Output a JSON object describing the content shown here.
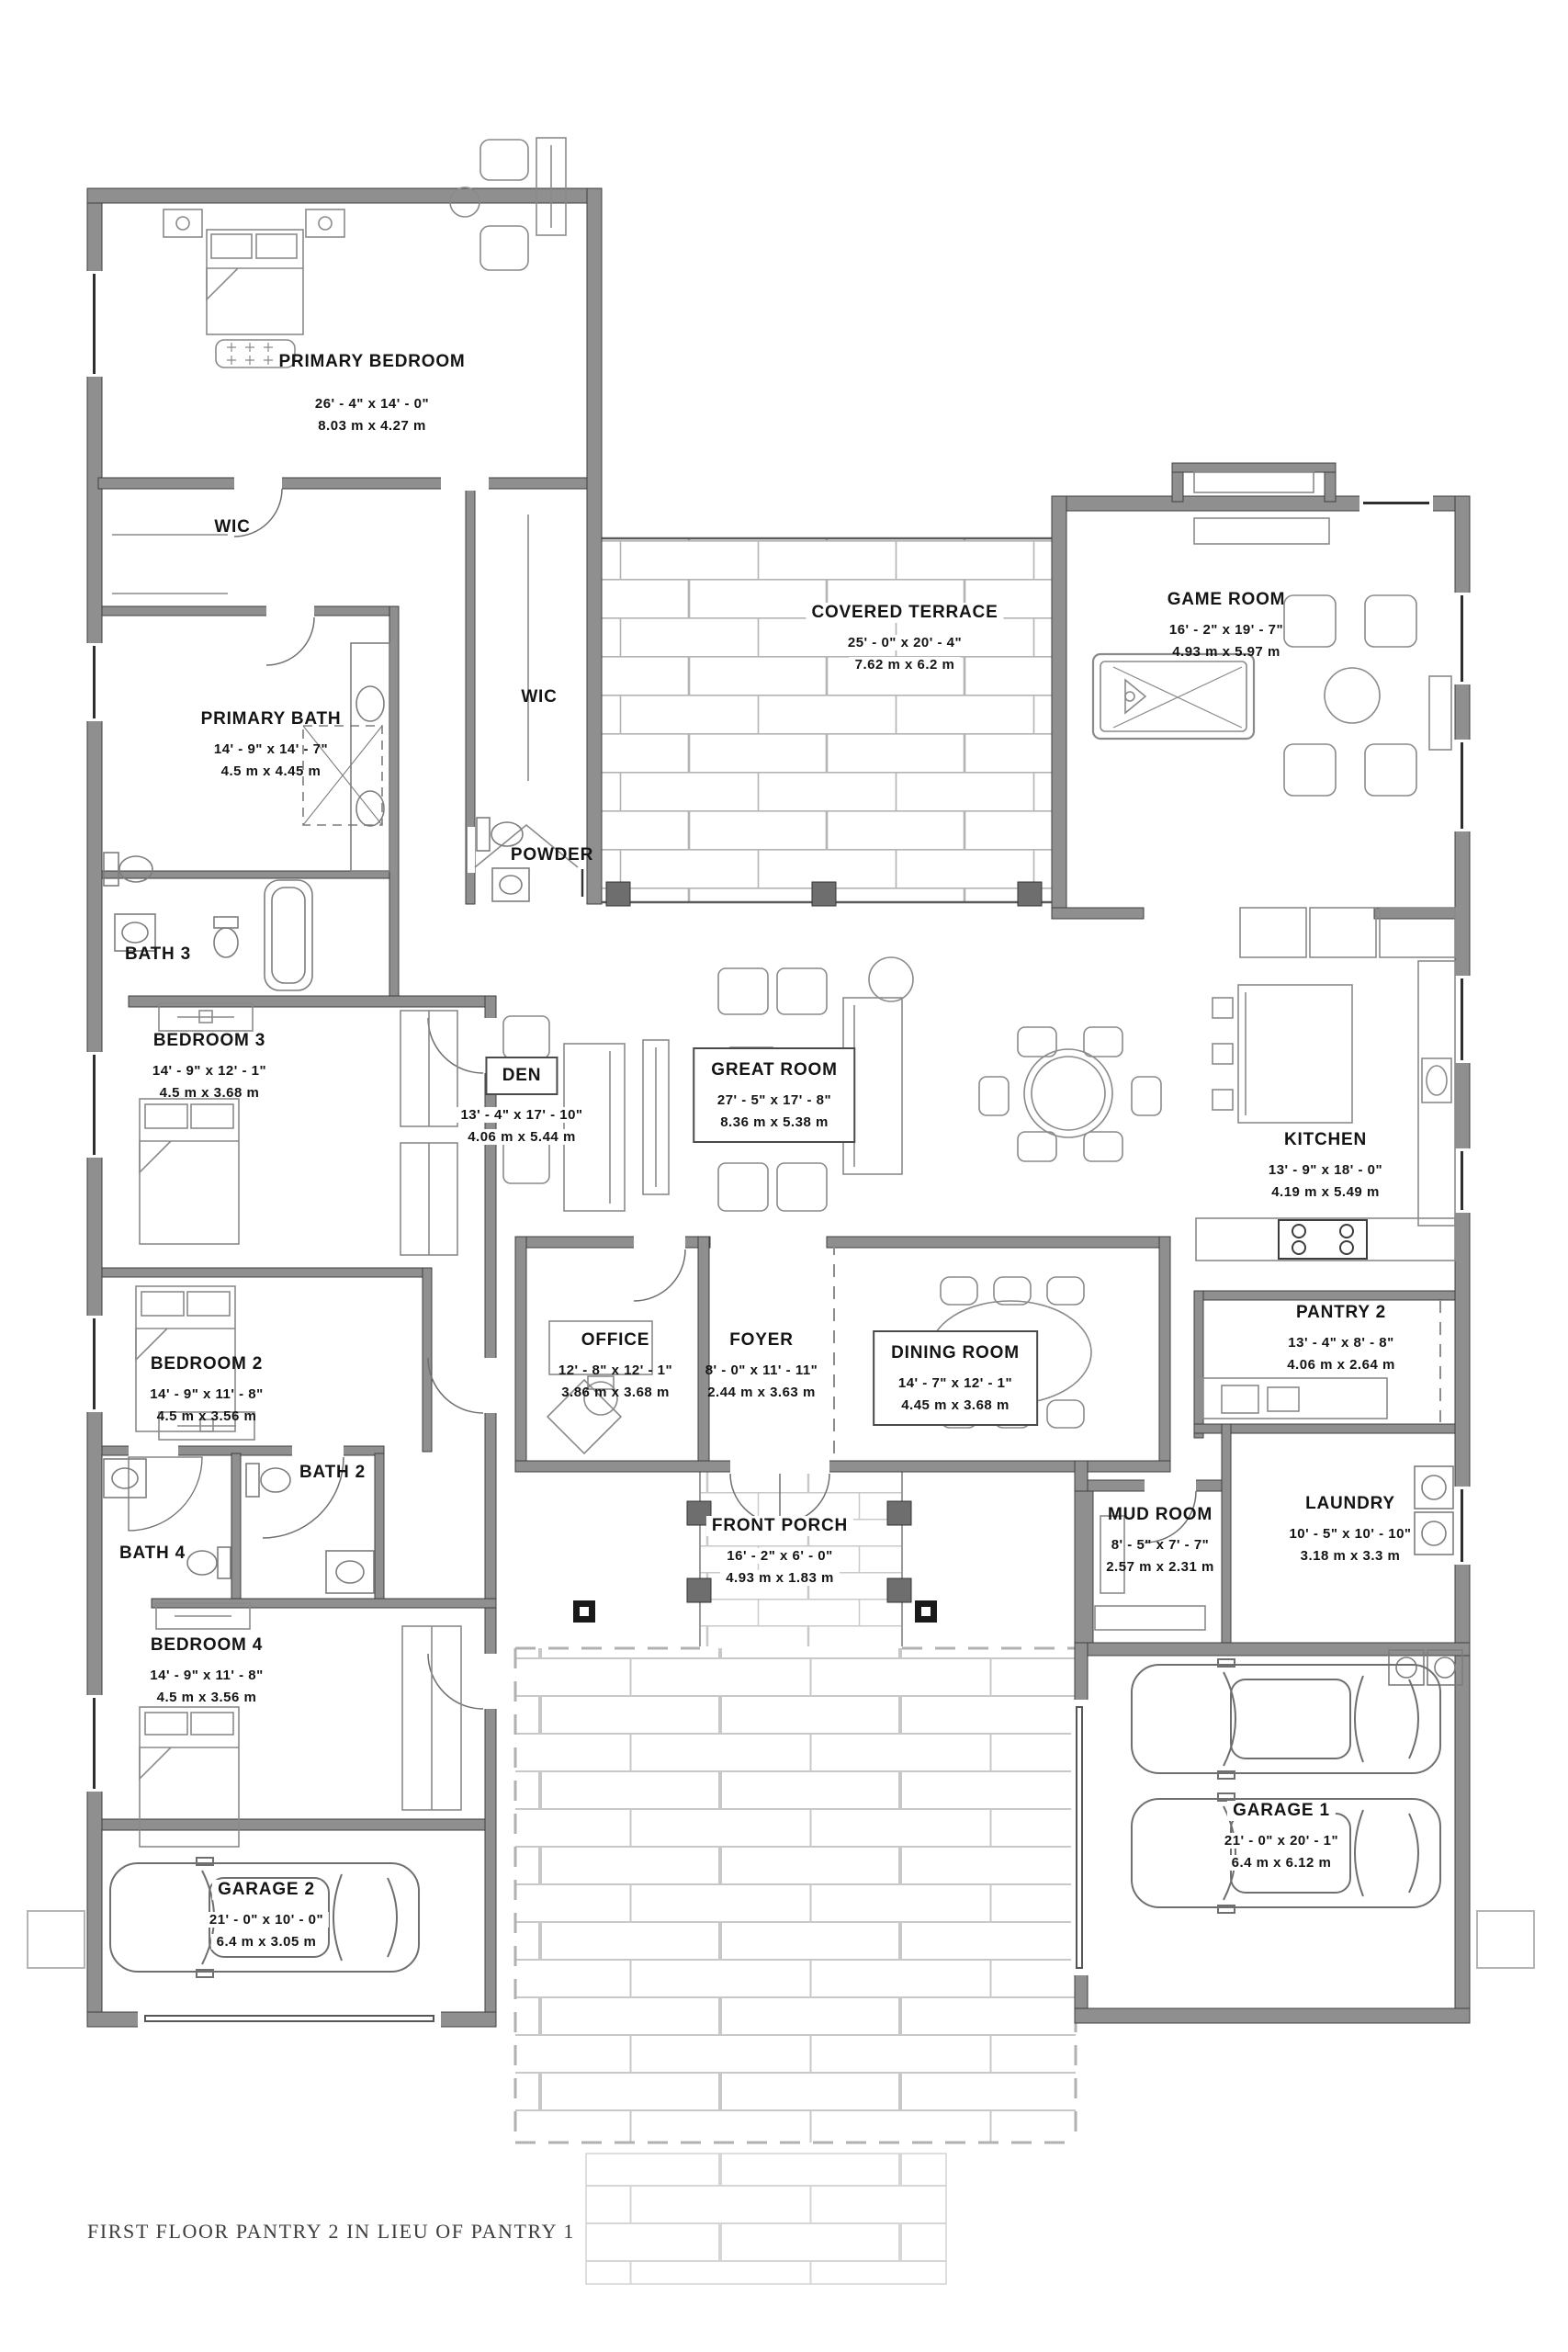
{
  "footer": {
    "note": "FIRST FLOOR PANTRY 2 IN LIEU OF PANTRY 1"
  },
  "colors": {
    "wall_fill": "#8f8f8f",
    "wall_edge": "#3f3f3f",
    "furniture_line": "#8a8a8a",
    "terrace_brick_line": "#b4b4b4",
    "driveway_brick_line": "#c6c6c6",
    "label_text": "#141414"
  },
  "rooms": {
    "primary_bedroom": {
      "name": "PRIMARY BEDROOM",
      "imperial": "26' - 4\" x 14' - 0\"",
      "metric": "8.03 m x 4.27 m"
    },
    "wic_1": {
      "name": "WIC"
    },
    "wic_2": {
      "name": "WIC"
    },
    "primary_bath": {
      "name": "PRIMARY BATH",
      "imperial": "14' - 9\" x 14' - 7\"",
      "metric": "4.5 m x 4.45 m"
    },
    "powder": {
      "name": "POWDER"
    },
    "bath_3": {
      "name": "BATH 3"
    },
    "bedroom_3": {
      "name": "BEDROOM 3",
      "imperial": "14' - 9\" x 12' - 1\"",
      "metric": "4.5 m x 3.68 m"
    },
    "den": {
      "name": "DEN",
      "imperial": "13' - 4\" x 17' - 10\"",
      "metric": "4.06 m x 5.44 m"
    },
    "great_room": {
      "name": "GREAT ROOM",
      "imperial": "27' - 5\" x 17' - 8\"",
      "metric": "8.36 m x 5.38 m"
    },
    "covered_terrace": {
      "name": "COVERED TERRACE",
      "imperial": "25' - 0\" x 20' - 4\"",
      "metric": "7.62 m x 6.2 m"
    },
    "game_room": {
      "name": "GAME ROOM",
      "imperial": "16' - 2\" x 19' - 7\"",
      "metric": "4.93 m x 5.97 m"
    },
    "kitchen": {
      "name": "KITCHEN",
      "imperial": "13' - 9\" x 18' - 0\"",
      "metric": "4.19 m x 5.49 m"
    },
    "pantry_2": {
      "name": "PANTRY 2",
      "imperial": "13' - 4\" x 8' - 8\"",
      "metric": "4.06 m x 2.64 m"
    },
    "bedroom_2": {
      "name": "BEDROOM 2",
      "imperial": "14' - 9\" x 11' - 8\"",
      "metric": "4.5 m x 3.56 m"
    },
    "bath_2": {
      "name": "BATH 2"
    },
    "bath_4": {
      "name": "BATH 4"
    },
    "bedroom_4": {
      "name": "BEDROOM 4",
      "imperial": "14' - 9\" x 11' - 8\"",
      "metric": "4.5 m x 3.56 m"
    },
    "office": {
      "name": "OFFICE",
      "imperial": "12' - 8\" x 12' - 1\"",
      "metric": "3.86 m x 3.68 m"
    },
    "foyer": {
      "name": "FOYER",
      "imperial": "8' - 0\" x 11' - 11\"",
      "metric": "2.44 m x 3.63 m"
    },
    "dining_room": {
      "name": "DINING ROOM",
      "imperial": "14' - 7\" x 12' - 1\"",
      "metric": "4.45 m x 3.68 m"
    },
    "front_porch": {
      "name": "FRONT PORCH",
      "imperial": "16' - 2\" x 6' - 0\"",
      "metric": "4.93 m x 1.83 m"
    },
    "mud_room": {
      "name": "MUD ROOM",
      "imperial": "8' - 5\" x 7' - 7\"",
      "metric": "2.57 m x 2.31 m"
    },
    "laundry": {
      "name": "LAUNDRY",
      "imperial": "10' - 5\" x 10' - 10\"",
      "metric": "3.18 m x 3.3 m"
    },
    "garage_1": {
      "name": "GARAGE 1",
      "imperial": "21' - 0\" x 20' - 1\"",
      "metric": "6.4 m x 6.12 m"
    },
    "garage_2": {
      "name": "GARAGE 2",
      "imperial": "21' - 0\" x 10' - 0\"",
      "metric": "6.4 m x 3.05 m"
    }
  }
}
